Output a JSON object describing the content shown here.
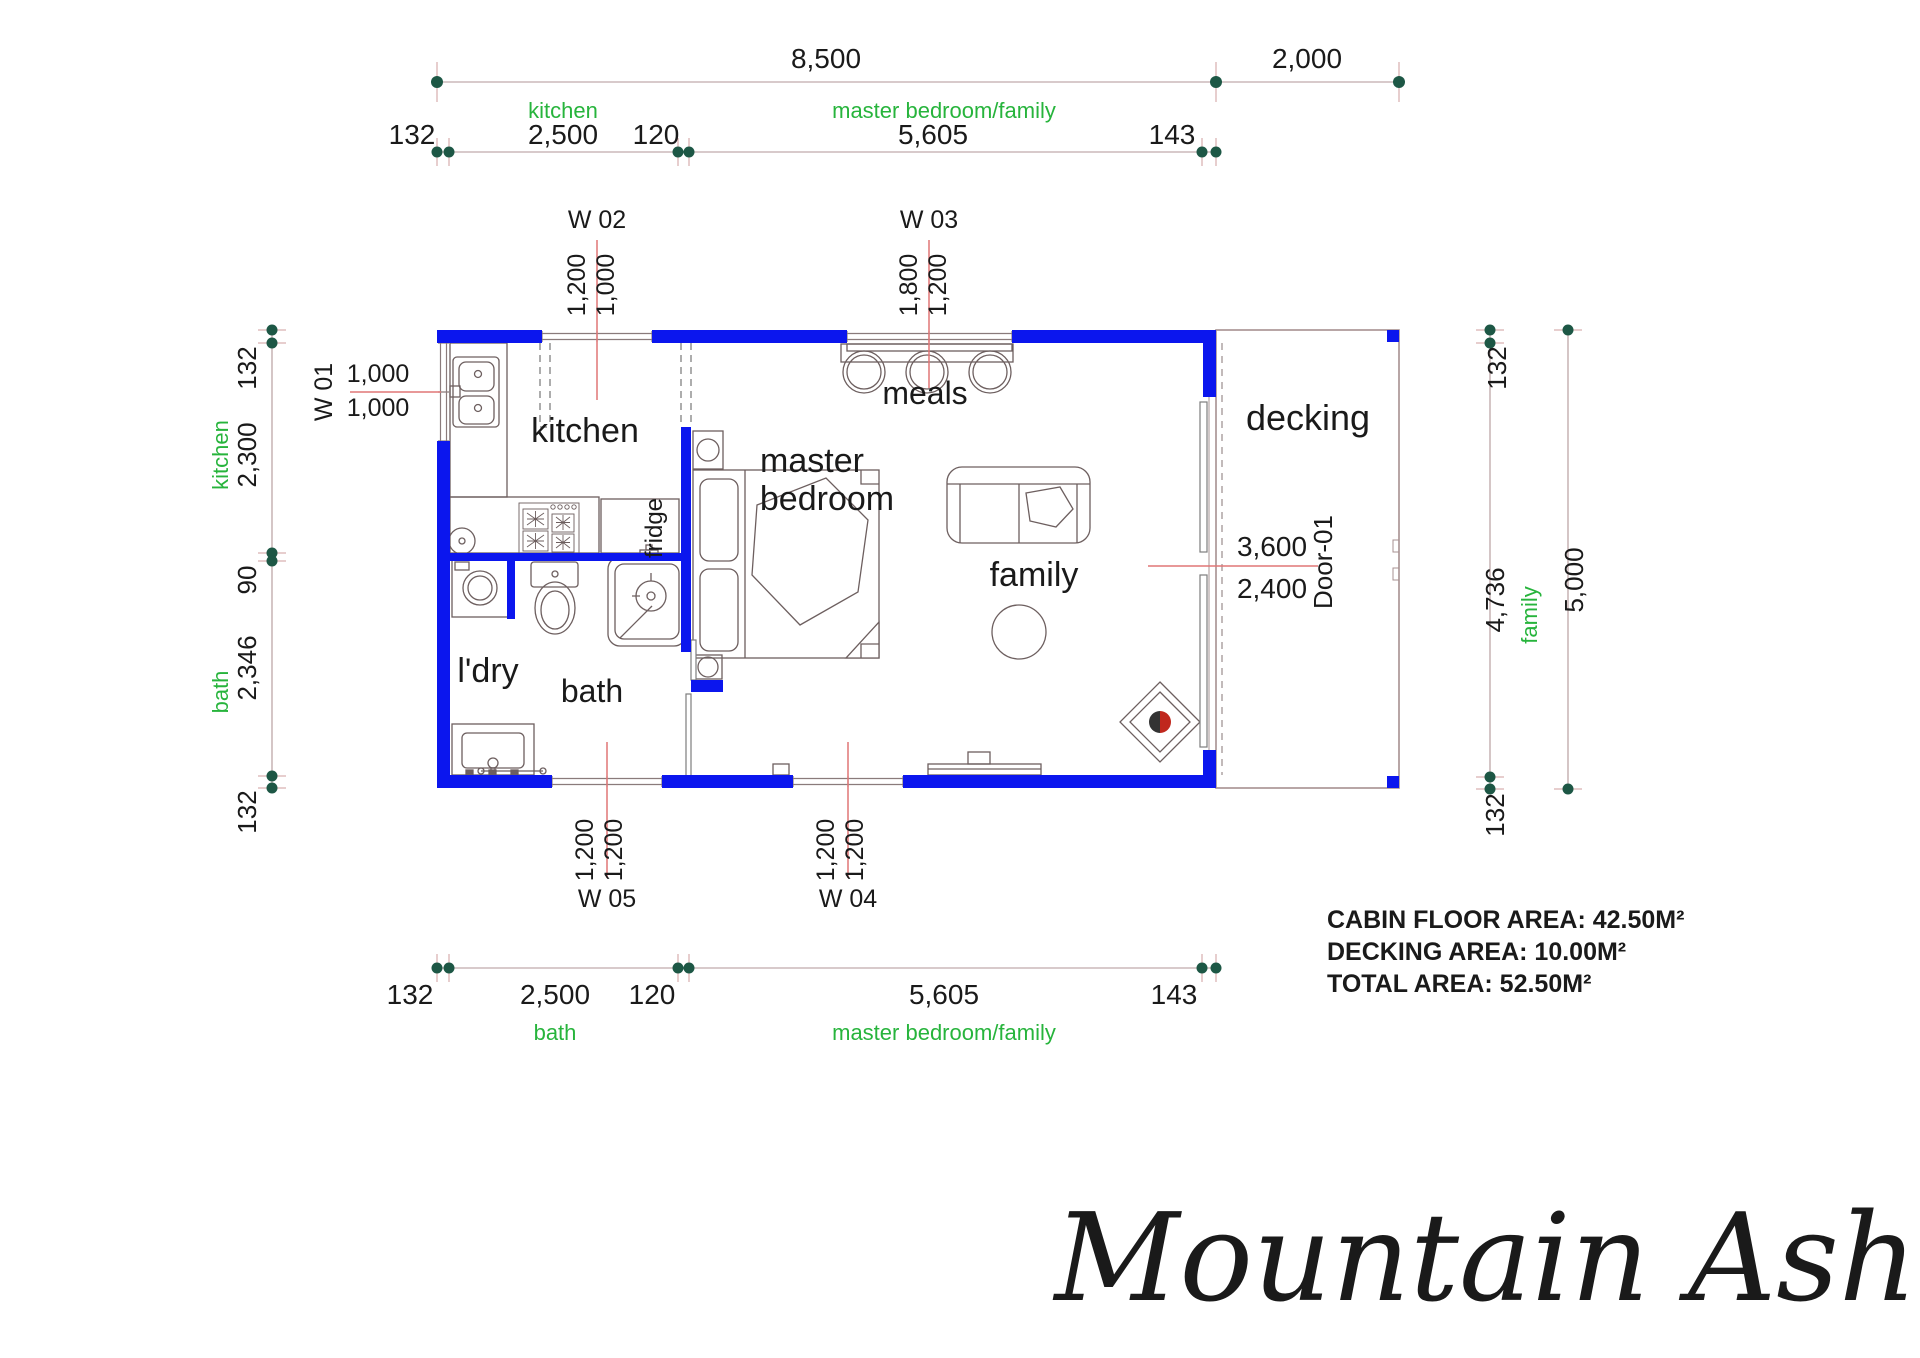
{
  "title": "Mountain Ash",
  "area_summary": {
    "cabin": "CABIN FLOOR AREA: 42.50M²",
    "decking": "DECKING AREA: 10.00M²",
    "total": "TOTAL AREA: 52.50M²"
  },
  "rooms": {
    "kitchen": "kitchen",
    "meals": "meals",
    "master_line1": "master",
    "master_line2": "bedroom",
    "family": "family",
    "decking": "decking",
    "ldry": "l'dry",
    "bath": "bath",
    "fridge": "fridge"
  },
  "dims": {
    "top": {
      "overall": "8,500",
      "decking": "2,000"
    },
    "top_seg": {
      "a": "132",
      "b": "2,500",
      "c": "120",
      "d": "5,605",
      "e": "143"
    },
    "top_rooms": {
      "left": "kitchen",
      "right": "master bedroom/family"
    },
    "bottom_seg": {
      "a": "132",
      "b": "2,500",
      "c": "120",
      "d": "5,605",
      "e": "143"
    },
    "bottom_rooms": {
      "left": "bath",
      "right": "master bedroom/family"
    },
    "left": {
      "a": "132",
      "b": "2,300",
      "room_top": "kitchen",
      "c": "90",
      "d": "2,346",
      "room_bottom": "bath",
      "e": "132"
    },
    "right": {
      "a": "132",
      "b": "4,736",
      "room": "family",
      "c": "132",
      "overall": "5,000"
    }
  },
  "openings": {
    "w01": {
      "id": "W 01",
      "a": "1,000",
      "b": "1,000"
    },
    "w02": {
      "id": "W 02",
      "a": "1,200",
      "b": "1,000"
    },
    "w03": {
      "id": "W 03",
      "a": "1,800",
      "b": "1,200"
    },
    "w04": {
      "id": "W 04",
      "a": "1,200",
      "b": "1,200"
    },
    "w05": {
      "id": "W 05",
      "a": "1,200",
      "b": "1,200"
    },
    "door01": {
      "id": "Door-01",
      "a": "3,600",
      "b": "2,400"
    }
  },
  "colors": {
    "wall": "#0b16ee",
    "room_green": "#27b43c",
    "dim_dot": "#1d5745",
    "leader_red": "#e07676",
    "dim_line": "#b29697"
  }
}
